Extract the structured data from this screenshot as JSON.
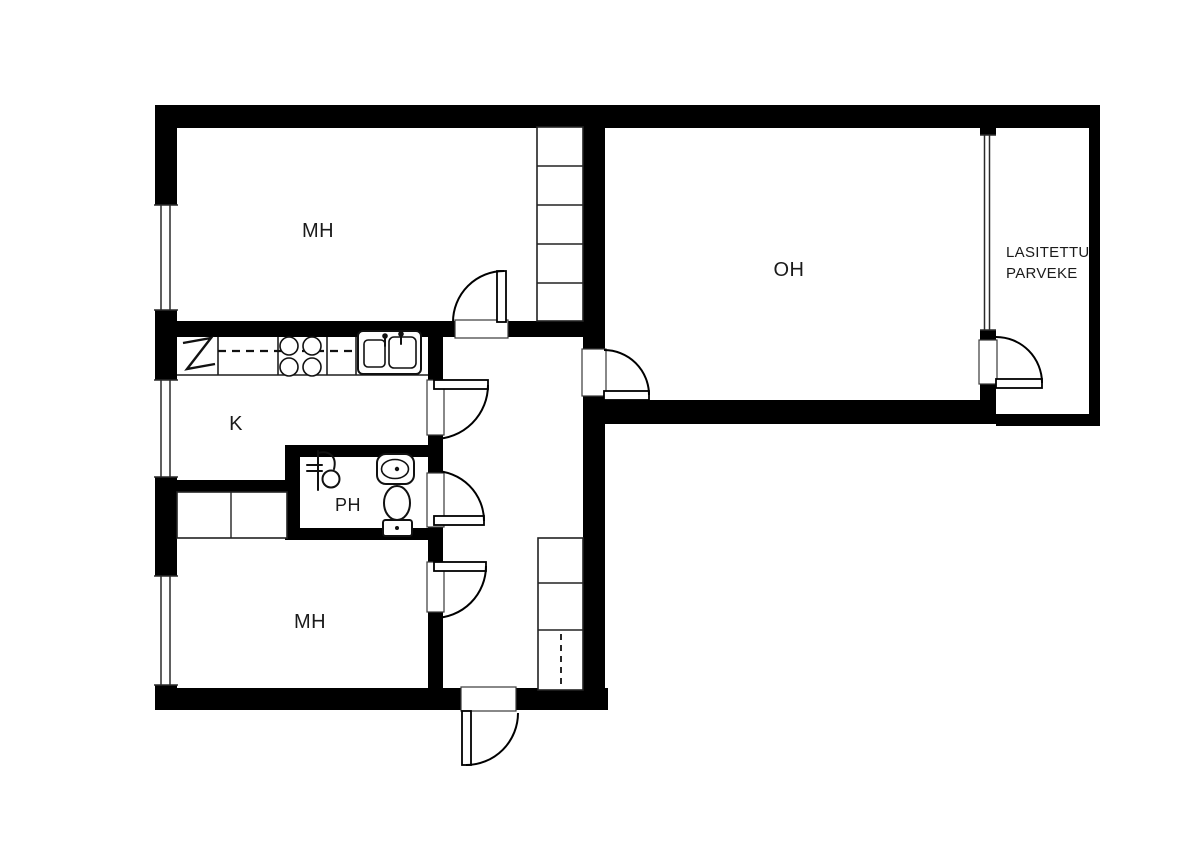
{
  "rooms": {
    "bedroom_top": {
      "label": "MH"
    },
    "living_room": {
      "label": "OH"
    },
    "glazed_balcony": {
      "label_line1": "LASITETTU",
      "label_line2": "PARVEKE"
    },
    "kitchen": {
      "label": "K"
    },
    "bathroom": {
      "label": "PH"
    },
    "bedroom_bottom": {
      "label": "MH"
    }
  },
  "colors": {
    "walls": "#000000",
    "fixture_lines": "#111111",
    "background": "#ffffff",
    "label_text": "#1b1b1b"
  },
  "fixtures": {
    "kitchen": [
      "fridge-icon",
      "stove-icon",
      "sink-icon"
    ],
    "bathroom": [
      "shower-icon",
      "washbasin-icon",
      "toilet-icon"
    ],
    "storage": [
      "wardrobe",
      "hallway-closet"
    ]
  }
}
